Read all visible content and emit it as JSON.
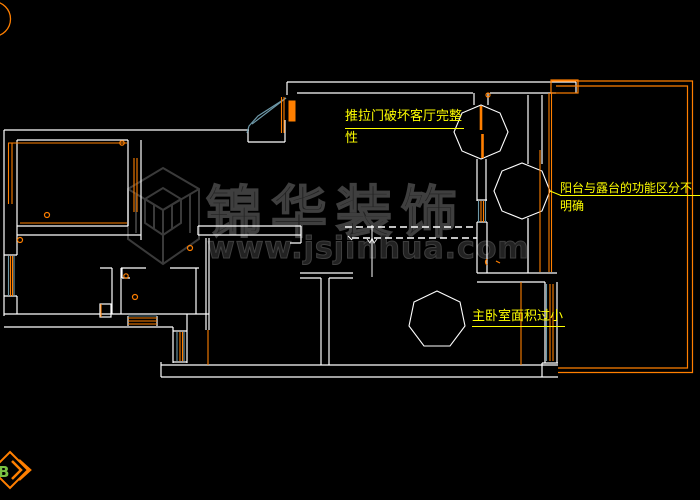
{
  "drawing": {
    "type": "floor-plan-cad",
    "background": "#000000"
  },
  "watermark": {
    "brand": "锦华装饰",
    "url": "www.jsjinhua.com",
    "logo": "jinhua-cube-logo",
    "color": "#3f3f3f"
  },
  "annotations": [
    {
      "id": "sliding-door-note",
      "lines": [
        "推拉门破坏客厅完整",
        "性"
      ],
      "color": "#ffff00"
    },
    {
      "id": "balcony-note",
      "lines": [
        "阳台与露台的功能区分不",
        "明确"
      ],
      "color": "#ffff00"
    },
    {
      "id": "bedroom-note",
      "lines": [
        "主卧室面积过小"
      ],
      "color": "#ffff00"
    }
  ],
  "compass": {
    "letter": "B",
    "letter_color": "#7ac142",
    "accent": "#ff7f00"
  },
  "colors": {
    "wall": "#ffffff",
    "trim": "#ff7f00",
    "glass": "#6d98a8",
    "label": "#ffff00",
    "watermark": "#3f3f3f"
  }
}
